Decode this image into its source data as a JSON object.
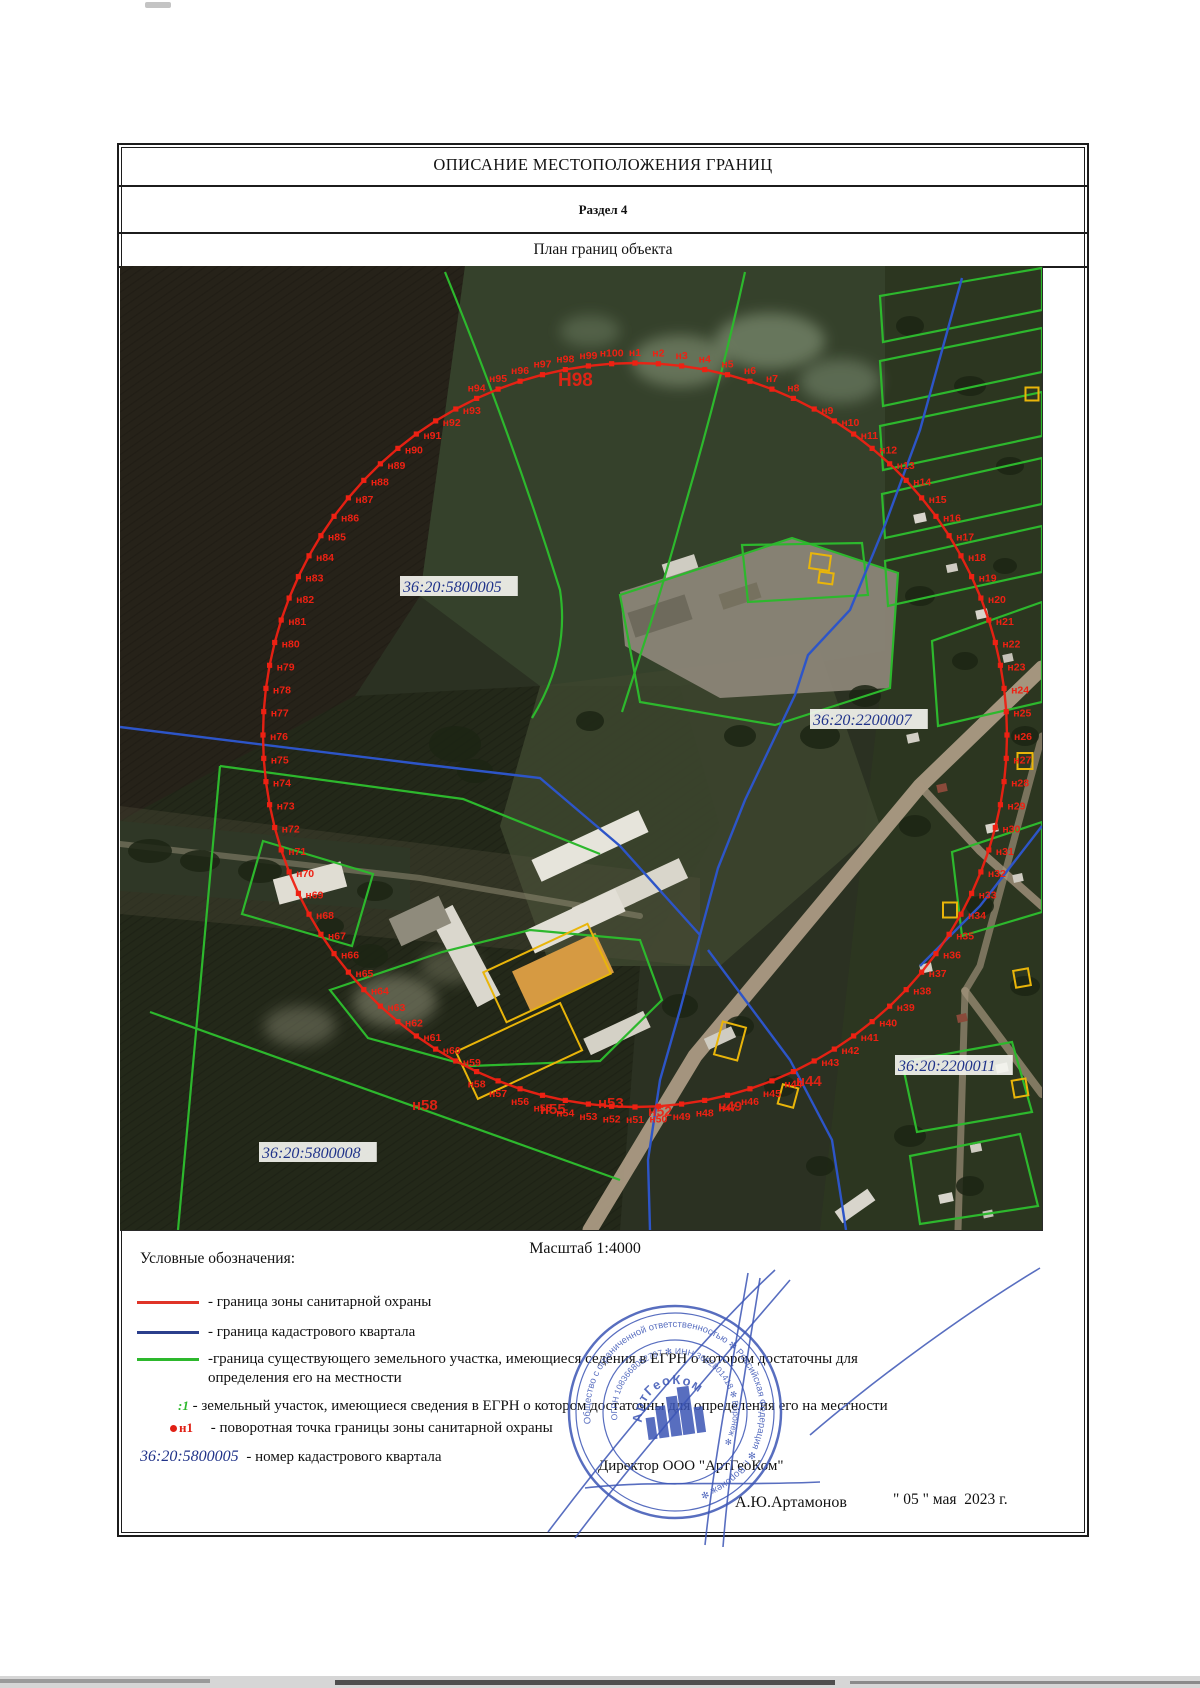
{
  "page": {
    "title": "ОПИСАНИЕ МЕСТОПОЛОЖЕНИЯ ГРАНИЦ",
    "section": "Раздел 4",
    "subtitle": "План границ объекта"
  },
  "scale_label": "Масштаб 1:4000",
  "legend": {
    "heading": "Условные обозначения:",
    "items": [
      {
        "color": "#e03428",
        "y": 1293,
        "label": "- граница зоны санитарной охраны"
      },
      {
        "color": "#2b3f8c",
        "y": 1323,
        "label": "- граница кадастрового квартала"
      },
      {
        "color": "#2db82d",
        "y": 1350,
        "label": "-граница существующего земельного участка, имеющиеся седения в ЕГРН о котором достаточны для определения его на местности"
      }
    ],
    "parcel_item": {
      "symbol": ":1",
      "label": "- земельный участок, имеющиеся сведения в ЕГРН о котором достаточны для определения его на местности"
    },
    "point_item": {
      "symbol": "н1",
      "label": "- поворотная точка границы зоны санитарной охраны"
    },
    "quarter_item": {
      "number": "36:20:5800005",
      "label": "- номер кадастрового квартала"
    }
  },
  "signature": {
    "director_line": "Директор ООО \"АртГеоКом\"",
    "name": "А.Ю.Артамонов",
    "date": "\" 05 \" мая  2023 г."
  },
  "stamp": {
    "outer_text": "Общество с ограниченной ответственностью ✻ Российская Федерация ✻ г. Воронеж ✻",
    "inner_text": "ОГРН 1083668052797 ✻ ИНН 3662801418 ✻ Воронеж ✻",
    "org_name": "АртГеоКом",
    "color": "#3b55b5"
  },
  "map": {
    "width": 922,
    "height": 964,
    "colors": {
      "boundary": "#ee2113",
      "parcel_green": "#2db82d",
      "quarter_blue": "#2d55c8",
      "object_yellow": "#e9b50a",
      "cad_text": "#20338a",
      "cad_bg": "#f4f4ef"
    },
    "boundary": {
      "cx": 515,
      "cy": 469,
      "r": 372,
      "count": 100,
      "prefix": "н"
    },
    "cadastral_labels": [
      {
        "text": "36:20:5800005",
        "x": 283,
        "y": 311
      },
      {
        "text": "36:20:2200007",
        "x": 693,
        "y": 444
      },
      {
        "text": "36:20:2200011",
        "x": 778,
        "y": 790
      },
      {
        "text": "36:20:5800008",
        "x": 142,
        "y": 877
      }
    ],
    "large_labels": [
      {
        "text": "Н98",
        "x": 438,
        "y": 120,
        "s": 19
      },
      {
        "text": "н58",
        "x": 292,
        "y": 844,
        "s": 15
      },
      {
        "text": "н55",
        "x": 420,
        "y": 848,
        "s": 15
      },
      {
        "text": "н53",
        "x": 478,
        "y": 842,
        "s": 15
      },
      {
        "text": "н52",
        "x": 528,
        "y": 850,
        "s": 14
      },
      {
        "text": "н49",
        "x": 598,
        "y": 845,
        "s": 14
      },
      {
        "text": "н44",
        "x": 676,
        "y": 820,
        "s": 15
      }
    ],
    "fields": [
      {
        "points": "0,0 345,0 300,330 235,430 0,555",
        "fill": "#262219",
        "tex": true
      },
      {
        "points": "345,0 765,0 765,385 560,420 420,420 300,330",
        "fill": "#35412b"
      },
      {
        "points": "765,0 922,0 922,964 700,964 745,560 765,385",
        "fill": "#2c3620"
      },
      {
        "points": "0,555 235,430 420,420 560,420 600,560 520,700 500,964 0,964",
        "fill": "#232819",
        "tex": true
      },
      {
        "points": "0,555 290,582 290,645 0,625",
        "fill": "#1f2c1c"
      },
      {
        "points": "420,420 700,385 760,560 600,700 430,700 380,560",
        "fill": "#3c452e",
        "op": 0.9
      },
      {
        "points": "0,540 580,612 580,700 0,648",
        "fill": "#55523f",
        "op": 0.3
      },
      {
        "points": "500,326 672,272 778,307 770,422 600,432 505,380",
        "fill": "#8b8577",
        "op": 0.95
      }
    ],
    "patches": [
      {
        "cx": 560,
        "cy": 95,
        "rx": 48,
        "ry": 26,
        "f": "#93a386",
        "op": 0.5
      },
      {
        "cx": 650,
        "cy": 75,
        "rx": 55,
        "ry": 28,
        "f": "#9aab8d",
        "op": 0.5
      },
      {
        "cx": 720,
        "cy": 115,
        "rx": 40,
        "ry": 22,
        "f": "#8a9c80",
        "op": 0.45
      },
      {
        "cx": 470,
        "cy": 65,
        "rx": 30,
        "ry": 16,
        "f": "#7d8f74",
        "op": 0.4
      },
      {
        "cx": 275,
        "cy": 735,
        "rx": 42,
        "ry": 26,
        "f": "#9a9a82",
        "op": 0.5
      },
      {
        "cx": 330,
        "cy": 700,
        "rx": 30,
        "ry": 18,
        "f": "#8a8a74",
        "op": 0.4
      },
      {
        "cx": 180,
        "cy": 760,
        "rx": 36,
        "ry": 20,
        "f": "#9a9a82",
        "op": 0.4
      }
    ],
    "roads": [
      {
        "d": "M470,964 L575,790 L700,640 L800,520 L922,402",
        "w": 15,
        "c": "#b1a088",
        "op": 0.9
      },
      {
        "d": "M800,520 L860,585 L922,640",
        "w": 8,
        "c": "#a5957e",
        "op": 0.8
      },
      {
        "d": "M845,725 L922,828",
        "w": 8,
        "c": "#a5957e",
        "op": 0.7
      },
      {
        "d": "M0,578 L300,612 L520,650",
        "w": 6,
        "c": "#8f8a72",
        "op": 0.55
      },
      {
        "d": "M922,470 L860,700 L845,725 L838,964",
        "w": 7,
        "c": "#a5957e",
        "op": 0.65
      }
    ],
    "trees": [
      {
        "cx": 335,
        "cy": 478,
        "rx": 26,
        "ry": 18
      },
      {
        "cx": 355,
        "cy": 505,
        "rx": 18,
        "ry": 12
      },
      {
        "cx": 470,
        "cy": 455,
        "rx": 14,
        "ry": 10
      },
      {
        "cx": 620,
        "cy": 470,
        "rx": 16,
        "ry": 11
      },
      {
        "cx": 700,
        "cy": 470,
        "rx": 20,
        "ry": 13
      },
      {
        "cx": 745,
        "cy": 430,
        "rx": 16,
        "ry": 11
      },
      {
        "cx": 790,
        "cy": 60,
        "rx": 14,
        "ry": 10
      },
      {
        "cx": 850,
        "cy": 120,
        "rx": 16,
        "ry": 10
      },
      {
        "cx": 890,
        "cy": 200,
        "rx": 14,
        "ry": 9
      },
      {
        "cx": 800,
        "cy": 330,
        "rx": 15,
        "ry": 10
      },
      {
        "cx": 845,
        "cy": 395,
        "rx": 13,
        "ry": 9
      },
      {
        "cx": 905,
        "cy": 470,
        "rx": 14,
        "ry": 10
      },
      {
        "cx": 795,
        "cy": 560,
        "rx": 16,
        "ry": 11
      },
      {
        "cx": 860,
        "cy": 640,
        "rx": 14,
        "ry": 10
      },
      {
        "cx": 905,
        "cy": 720,
        "rx": 15,
        "ry": 10
      },
      {
        "cx": 790,
        "cy": 870,
        "rx": 16,
        "ry": 11
      },
      {
        "cx": 850,
        "cy": 920,
        "rx": 14,
        "ry": 10
      },
      {
        "cx": 885,
        "cy": 300,
        "rx": 12,
        "ry": 8
      },
      {
        "cx": 250,
        "cy": 690,
        "rx": 18,
        "ry": 12
      },
      {
        "cx": 210,
        "cy": 660,
        "rx": 14,
        "ry": 9
      },
      {
        "cx": 560,
        "cy": 740,
        "rx": 18,
        "ry": 12
      },
      {
        "cx": 620,
        "cy": 760,
        "rx": 14,
        "ry": 10
      },
      {
        "cx": 660,
        "cy": 820,
        "rx": 16,
        "ry": 11
      },
      {
        "cx": 700,
        "cy": 900,
        "rx": 14,
        "ry": 10
      },
      {
        "cx": 30,
        "cy": 585,
        "rx": 22,
        "ry": 12
      },
      {
        "cx": 80,
        "cy": 595,
        "rx": 20,
        "ry": 11
      },
      {
        "cx": 140,
        "cy": 605,
        "rx": 22,
        "ry": 12
      },
      {
        "cx": 200,
        "cy": 615,
        "rx": 20,
        "ry": 11
      },
      {
        "cx": 255,
        "cy": 625,
        "rx": 18,
        "ry": 10
      }
    ],
    "buildings": [
      {
        "cx": 560,
        "cy": 300,
        "w": 34,
        "h": 14,
        "rot": -18,
        "f": "#cfccc2"
      },
      {
        "cx": 620,
        "cy": 330,
        "w": 40,
        "h": 16,
        "rot": -18,
        "f": "#76715f"
      },
      {
        "cx": 540,
        "cy": 350,
        "w": 60,
        "h": 26,
        "rot": -18,
        "f": "#6e6a5c"
      },
      {
        "cx": 470,
        "cy": 580,
        "w": 118,
        "h": 24,
        "rot": -25,
        "f": "#e6e4db"
      },
      {
        "cx": 510,
        "cy": 627,
        "w": 118,
        "h": 22,
        "rot": -25,
        "f": "#d9d6cb"
      },
      {
        "cx": 345,
        "cy": 690,
        "w": 26,
        "h": 102,
        "rot": -28,
        "f": "#dad7cd"
      },
      {
        "cx": 300,
        "cy": 655,
        "w": 55,
        "h": 30,
        "rot": -25,
        "f": "#8f8b7c"
      },
      {
        "cx": 455,
        "cy": 655,
        "w": 100,
        "h": 25,
        "rot": -25,
        "f": "#e2dfd6"
      },
      {
        "cx": 443,
        "cy": 706,
        "w": 92,
        "h": 44,
        "rot": -25,
        "f": "#d69a42"
      },
      {
        "cx": 497,
        "cy": 767,
        "w": 66,
        "h": 18,
        "rot": -25,
        "f": "#d4d1c6"
      },
      {
        "cx": 190,
        "cy": 617,
        "w": 70,
        "h": 26,
        "rot": -15,
        "f": "#e0ddd3"
      },
      {
        "cx": 600,
        "cy": 772,
        "w": 30,
        "h": 12,
        "rot": -25,
        "f": "#cfccc2"
      },
      {
        "cx": 735,
        "cy": 940,
        "w": 40,
        "h": 14,
        "rot": -35,
        "f": "#d8d5cc"
      },
      {
        "cx": 800,
        "cy": 252,
        "w": 12,
        "h": 9,
        "rot": -12,
        "f": "#d8d5cc"
      },
      {
        "cx": 832,
        "cy": 302,
        "w": 11,
        "h": 8,
        "rot": -12,
        "f": "#cfccc2"
      },
      {
        "cx": 862,
        "cy": 348,
        "w": 12,
        "h": 9,
        "rot": -12,
        "f": "#d8d5cc"
      },
      {
        "cx": 888,
        "cy": 392,
        "w": 10,
        "h": 8,
        "rot": -12,
        "f": "#c5c2b8"
      },
      {
        "cx": 793,
        "cy": 472,
        "w": 12,
        "h": 9,
        "rot": -12,
        "f": "#d2cfc5"
      },
      {
        "cx": 822,
        "cy": 522,
        "w": 10,
        "h": 8,
        "rot": -12,
        "f": "#8a4a3a"
      },
      {
        "cx": 872,
        "cy": 562,
        "w": 12,
        "h": 9,
        "rot": -12,
        "f": "#d8d5cc"
      },
      {
        "cx": 898,
        "cy": 612,
        "w": 10,
        "h": 8,
        "rot": -12,
        "f": "#cfccc2"
      },
      {
        "cx": 806,
        "cy": 702,
        "w": 12,
        "h": 9,
        "rot": -12,
        "f": "#d2cfc5"
      },
      {
        "cx": 842,
        "cy": 752,
        "w": 10,
        "h": 8,
        "rot": -12,
        "f": "#8a4a3a"
      },
      {
        "cx": 882,
        "cy": 802,
        "w": 12,
        "h": 9,
        "rot": -12,
        "f": "#d8d5cc"
      },
      {
        "cx": 856,
        "cy": 882,
        "w": 11,
        "h": 8,
        "rot": -12,
        "f": "#cfccc2"
      },
      {
        "cx": 826,
        "cy": 932,
        "w": 14,
        "h": 9,
        "rot": -12,
        "f": "#d8d5cc"
      },
      {
        "cx": 868,
        "cy": 948,
        "w": 10,
        "h": 7,
        "rot": -12,
        "f": "#c5c2b8"
      }
    ],
    "greens": [
      {
        "d": "M625,6 Q600,120 562,250 Q540,330 520,390 L502,446"
      },
      {
        "d": "M325,6 Q392,170 440,324 Q450,390 412,452"
      },
      {
        "poly": "500,329 672,272 778,307 770,422 655,459 520,436",
        "closed": true
      },
      {
        "poly": "622,279 742,277 748,329 628,336",
        "closed": true
      },
      {
        "poly": "760,30 922,2 922,44 763,76",
        "closed": true
      },
      {
        "poly": "760,95 922,62 922,106 763,140",
        "closed": true
      },
      {
        "poly": "760,160 922,126 922,170 763,204",
        "closed": true
      },
      {
        "poly": "762,228 922,192 922,238 765,272",
        "closed": true
      },
      {
        "poly": "765,295 922,260 922,306 768,340",
        "closed": true
      },
      {
        "poly": "812,375 922,336 922,436 818,460",
        "closed": true
      },
      {
        "poly": "832,586 922,556 922,646 842,670",
        "closed": true
      },
      {
        "poly": "782,796 892,776 912,846 797,866",
        "closed": true
      },
      {
        "poly": "790,890 900,868 918,940 800,958",
        "closed": true
      },
      {
        "d": "M100,500 L343,533 L480,588"
      },
      {
        "d": "M100,500 L82,700 L58,964"
      },
      {
        "poly": "143,575 253,608 232,680 122,648",
        "closed": true
      },
      {
        "poly": "210,724 322,686 410,664 520,674 542,734 480,795 350,800 248,772",
        "closed": true
      },
      {
        "d": "M30,746 L500,914"
      }
    ],
    "blues": [
      {
        "d": "M842,12 L800,164 L765,259 L730,344 L688,389 L675,429 L625,534 L598,602 L580,669"
      },
      {
        "d": "M0,461 L300,498 L420,512 L500,580 L580,669"
      },
      {
        "d": "M580,669 L560,744 L540,814 L528,894 L530,964"
      },
      {
        "d": "M588,684 L670,794 L712,874 L726,964"
      },
      {
        "d": "M922,560 L860,640 L800,700"
      }
    ],
    "yellows": [
      {
        "cx": 700,
        "cy": 296,
        "w": 20,
        "h": 15,
        "rot": 8
      },
      {
        "cx": 706,
        "cy": 312,
        "w": 14,
        "h": 11,
        "rot": 8
      },
      {
        "cx": 427,
        "cy": 707,
        "w": 115,
        "h": 55,
        "rot": -25
      },
      {
        "cx": 399,
        "cy": 785,
        "w": 115,
        "h": 52,
        "rot": -25
      },
      {
        "cx": 610,
        "cy": 775,
        "w": 24,
        "h": 34,
        "rot": 15
      },
      {
        "cx": 668,
        "cy": 830,
        "w": 16,
        "h": 20,
        "rot": 15
      },
      {
        "cx": 905,
        "cy": 495,
        "w": 15,
        "h": 16,
        "rot": 0
      },
      {
        "cx": 830,
        "cy": 644,
        "w": 14,
        "h": 15,
        "rot": 0
      },
      {
        "cx": 902,
        "cy": 712,
        "w": 15,
        "h": 17,
        "rot": -10
      },
      {
        "cx": 900,
        "cy": 822,
        "w": 14,
        "h": 17,
        "rot": -10
      },
      {
        "cx": 912,
        "cy": 128,
        "w": 13,
        "h": 13,
        "rot": 0
      }
    ]
  }
}
